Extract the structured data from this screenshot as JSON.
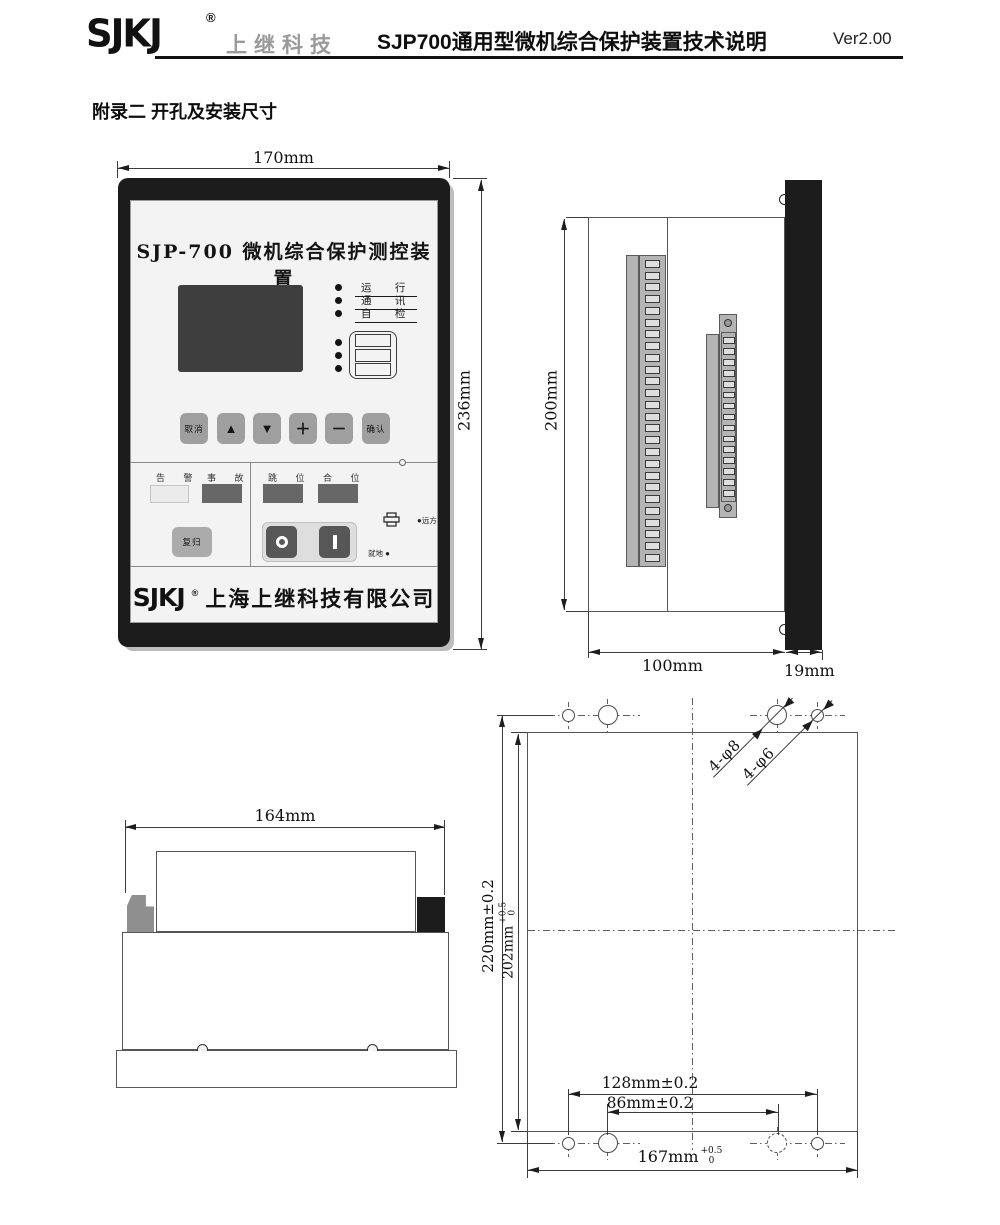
{
  "header": {
    "logo": "SJKJ",
    "logo_reg": "®",
    "company": "上继科技",
    "title": "SJP700通用型微机综合保护装置技术说明",
    "version": "Ver2.00"
  },
  "section_title": "附录二 开孔及安装尺寸",
  "front_view": {
    "width_dim": "170mm",
    "height_dim": "236mm",
    "panel_title": "SJP-700  微机综合保护测控装置",
    "led_labels": [
      "运 行",
      "通 讯",
      "自 检"
    ],
    "buttons": [
      "取消",
      "▲",
      "▼",
      "＋",
      "－",
      "确认"
    ],
    "signal_labels": {
      "alarm": "告 警",
      "fault": "事 故",
      "trip": "跳 位",
      "close": "合 位"
    },
    "reset_button": "复归",
    "remote_label": "远方",
    "local_label": "就地",
    "led_bullet": "●",
    "footer_logo": "SJKJ",
    "footer_reg": "®",
    "footer_company": "上海上继科技有限公司"
  },
  "side_view": {
    "height_dim": "200mm",
    "depth_dim": "100mm",
    "panel_dim": "19mm"
  },
  "bottom_view": {
    "width_dim": "164mm"
  },
  "cutout_view": {
    "outer_height_dim": "220mm±0.2",
    "cutout_height_value": "202mm",
    "cutout_height_tol_sup": "+0.5",
    "cutout_height_tol_sub": "0",
    "hole_span_outer": "128mm±0.2",
    "hole_span_inner": "86mm±0.2",
    "cutout_width_value": "167mm",
    "cutout_width_tol_sup": "+0.5",
    "cutout_width_tol_sub": "0",
    "leader_phi8": "4-φ8",
    "leader_phi6": "4-φ6"
  }
}
